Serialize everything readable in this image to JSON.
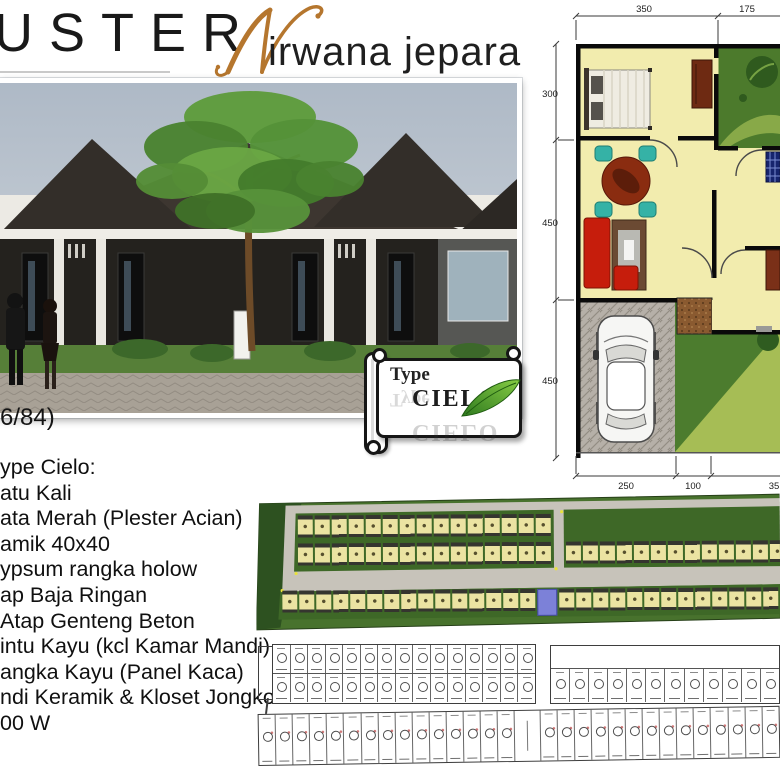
{
  "header": {
    "cluster_fragment": "USTER",
    "script_initial": "N",
    "project_name": "irwana jepara"
  },
  "photo": {
    "caption_fragment": "6/84)"
  },
  "type_sign": {
    "line1": "Type",
    "line2": "CIELO"
  },
  "specs": {
    "lines": [
      "ype Cielo:",
      "atu Kali",
      "ata Merah (Plester Acian)",
      "amik 40x40",
      "ypsum rangka holow",
      "ap Baja Ringan",
      "Atap Genteng Beton",
      "intu Kayu (kcl Kamar Mandi)",
      "angka Kayu (Panel Kaca)",
      "ndi Keramik & Kloset Jongkok",
      "00 W"
    ]
  },
  "floor_plan": {
    "dims_top": [
      "350",
      "175"
    ],
    "dims_left": [
      "300",
      "450",
      "450"
    ],
    "dims_bottom": [
      "250",
      "100",
      "35"
    ]
  },
  "site_plan": {
    "rows": [
      {
        "id": "tl1",
        "count": 15
      },
      {
        "id": "tl2",
        "count": 15
      },
      {
        "id": "tr",
        "count": 13
      },
      {
        "id": "bottom",
        "count": 29,
        "blue_index": 15
      }
    ]
  },
  "schematic": {
    "rows": [
      {
        "id": "s-tl1",
        "count": 15
      },
      {
        "id": "s-tl2",
        "count": 15
      },
      {
        "id": "s-tr",
        "count": 12
      },
      {
        "id": "s-bottom",
        "count": 30,
        "gap_index": 15
      }
    ]
  },
  "colors": {
    "accent_script": "#b5762e",
    "sky": "#b6bfca",
    "facade": "#24221e",
    "roof": "#3b342d",
    "lawn": "#567f38",
    "plan_floor": "#f2ecae",
    "plan_garden": "#4c7a2c",
    "site_green": "#48722d",
    "site_blue_plot": "#7c81d8"
  }
}
